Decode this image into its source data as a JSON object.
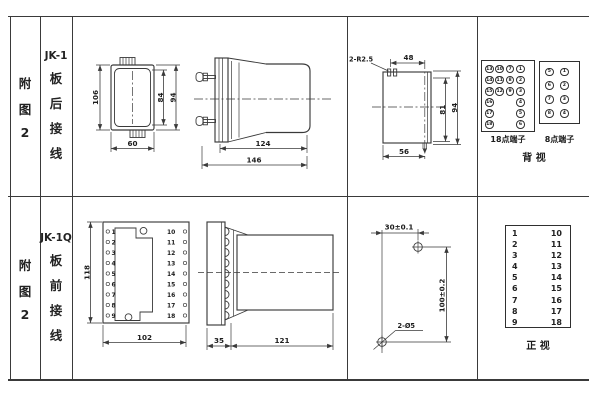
{
  "row1": {
    "figure_no": [
      "附",
      "图",
      "2"
    ],
    "model": "JK-1",
    "wiring": [
      "板",
      "后",
      "接",
      "线"
    ],
    "rear_view_case": {
      "height": "106",
      "width": "60",
      "inner_height": "84",
      "outer_height": "94"
    },
    "side_view": {
      "body_len": "124",
      "total_len": "146"
    },
    "cutout": {
      "slot_label": "2-R2.5",
      "top_w": "48",
      "inner_h": "81",
      "outer_h": "94",
      "bottom_w": "56"
    },
    "terminals_18": {
      "label": "18点端子",
      "rows": [
        [
          "13",
          "10",
          "7",
          "1"
        ],
        [
          "14",
          "11",
          "8",
          "2"
        ],
        [
          "15",
          "12",
          "9",
          "3"
        ],
        [
          "16",
          "",
          "",
          "4"
        ],
        [
          "17",
          "",
          "",
          "5"
        ],
        [
          "18",
          "",
          "",
          "6"
        ]
      ]
    },
    "terminals_8": {
      "label": "8点端子",
      "rows": [
        [
          "5",
          "1"
        ],
        [
          "6",
          "2"
        ],
        [
          "7",
          "3"
        ],
        [
          "8",
          "4"
        ]
      ]
    },
    "view_label": "背  视"
  },
  "row2": {
    "figure_no": [
      "附",
      "图",
      "2"
    ],
    "model": "JK-1Q",
    "wiring": [
      "板",
      "前",
      "接",
      "线"
    ],
    "front_view": {
      "height": "118",
      "width": "102",
      "left_terminals": [
        "1",
        "2",
        "3",
        "4",
        "5",
        "6",
        "7",
        "8",
        "9"
      ],
      "right_terminals": [
        "10",
        "11",
        "12",
        "13",
        "14",
        "15",
        "16",
        "17",
        "18"
      ]
    },
    "side_view": {
      "plate_depth": "35",
      "body_len": "121"
    },
    "drill": {
      "h_dim": "30±0.1",
      "v_dim": "100±0.2",
      "hole_label": "2-Ø5"
    },
    "terminal_table": {
      "left": [
        "1",
        "2",
        "3",
        "4",
        "5",
        "6",
        "7",
        "8",
        "9"
      ],
      "right": [
        "10",
        "11",
        "12",
        "13",
        "14",
        "15",
        "16",
        "17",
        "18"
      ],
      "view_label": "正  视"
    }
  }
}
